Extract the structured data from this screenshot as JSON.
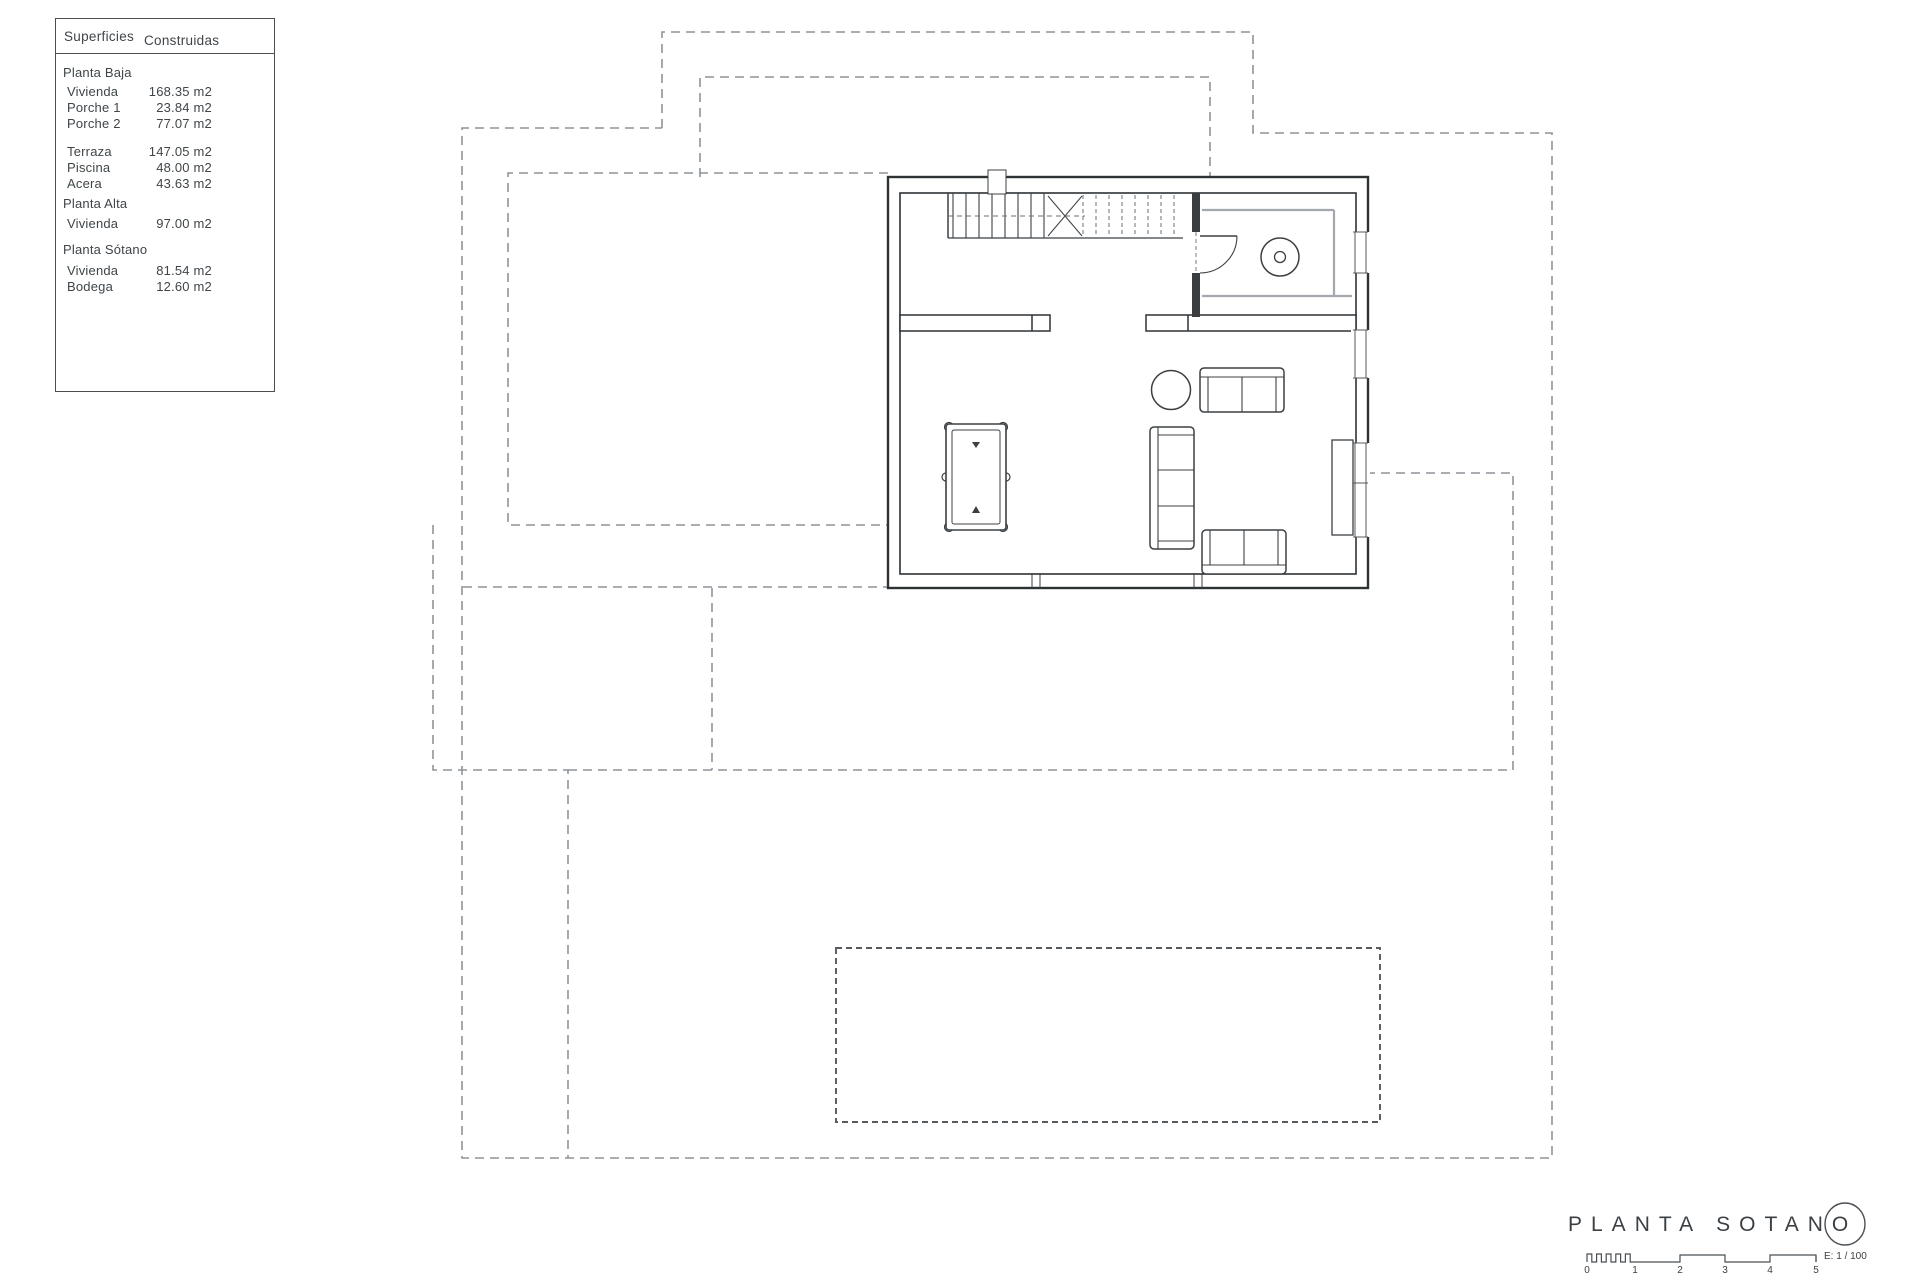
{
  "legend": {
    "header": {
      "col1": "Superficies",
      "col2": "Construidas"
    },
    "rows": [
      {
        "label": "Planta Baja",
        "value": ""
      },
      {
        "label": "Vivienda",
        "value": "168.35 m2"
      },
      {
        "label": "Porche 1",
        "value": "23.84 m2"
      },
      {
        "label": "Porche 2",
        "value": "77.07 m2"
      },
      {
        "label": "Terraza",
        "value": "147.05 m2"
      },
      {
        "label": "Piscina",
        "value": "48.00 m2"
      },
      {
        "label": "Acera",
        "value": "43.63 m2"
      },
      {
        "label": "Planta Alta",
        "value": ""
      },
      {
        "label": "Vivienda",
        "value": "97.00 m2"
      },
      {
        "label": "Planta Sótano",
        "value": ""
      },
      {
        "label": "Vivienda",
        "value": "81.54 m2"
      },
      {
        "label": "Bodega",
        "value": "12.60 m2"
      }
    ]
  },
  "title_block": {
    "title_word1": "PLANTA",
    "title_word2": "SOTANO",
    "scale_label": "E: 1 / 100",
    "scale_ticks": [
      "0",
      "1",
      "2",
      "3",
      "4",
      "5"
    ]
  },
  "colors": {
    "wall_line": "#2e3235",
    "furniture_line": "#3c4043",
    "dashed_outline": "#8e949a",
    "pool_dashed": "#565b5f",
    "tile_line": "#a2a8ad"
  }
}
